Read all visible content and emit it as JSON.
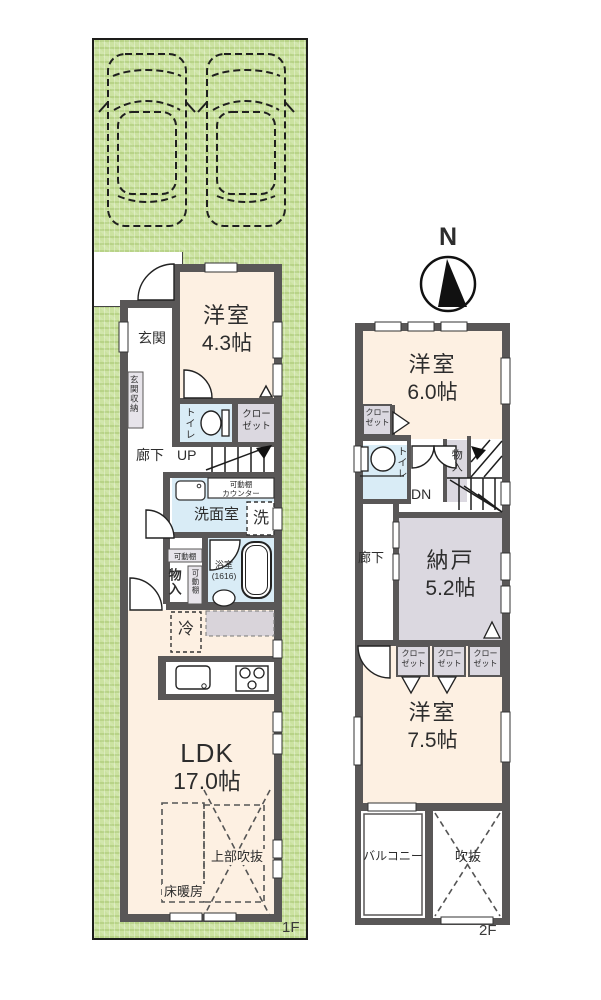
{
  "site": {
    "floor1_label": "1F",
    "floor2_label": "2F"
  },
  "compass": {
    "north_label": "N"
  },
  "floor1": {
    "entrance": "玄関",
    "entrance_storage": "玄関収納",
    "western_room": {
      "name": "洋室",
      "size": "4.3帖"
    },
    "toilet": "トイレ",
    "closet": "クローゼット",
    "hallway": "廊下",
    "stairs_up": "UP",
    "washroom": "洗面室",
    "washing_machine": "洗",
    "movable_counter": {
      "line1": "可動棚",
      "line2": "カウンター"
    },
    "movable_shelf_a": "可動棚",
    "storage": "物入",
    "movable_shelf_b": "可動棚",
    "bathroom": {
      "name": "浴室",
      "size": "(1616)"
    },
    "refrigerator": "冷",
    "ldk": {
      "name": "LDK",
      "size": "17.0帖"
    },
    "open_above": "上部吹抜",
    "floor_heating": "床暖房"
  },
  "floor2": {
    "western_room_6": {
      "name": "洋室",
      "size": "6.0帖"
    },
    "closet_a": "クローゼット",
    "toilet": "トイレ",
    "storage": "物入",
    "stairs_down": "DN",
    "hallway": "廊下",
    "storeroom": {
      "name": "納戸",
      "size": "5.2帖"
    },
    "closet_b": "クローゼット",
    "closet_c": "クローゼット",
    "closet_d": "クローゼット",
    "western_room_75": {
      "name": "洋室",
      "size": "7.5帖"
    },
    "balcony": "バルコニー",
    "void": "吹抜"
  },
  "colors": {
    "lot_green": "#cbe2a0",
    "wall_gray": "#595757",
    "room_cream": "#fdf0e2",
    "wet_blue": "#d9ecf6",
    "closet_gray": "#dbd8e0"
  }
}
